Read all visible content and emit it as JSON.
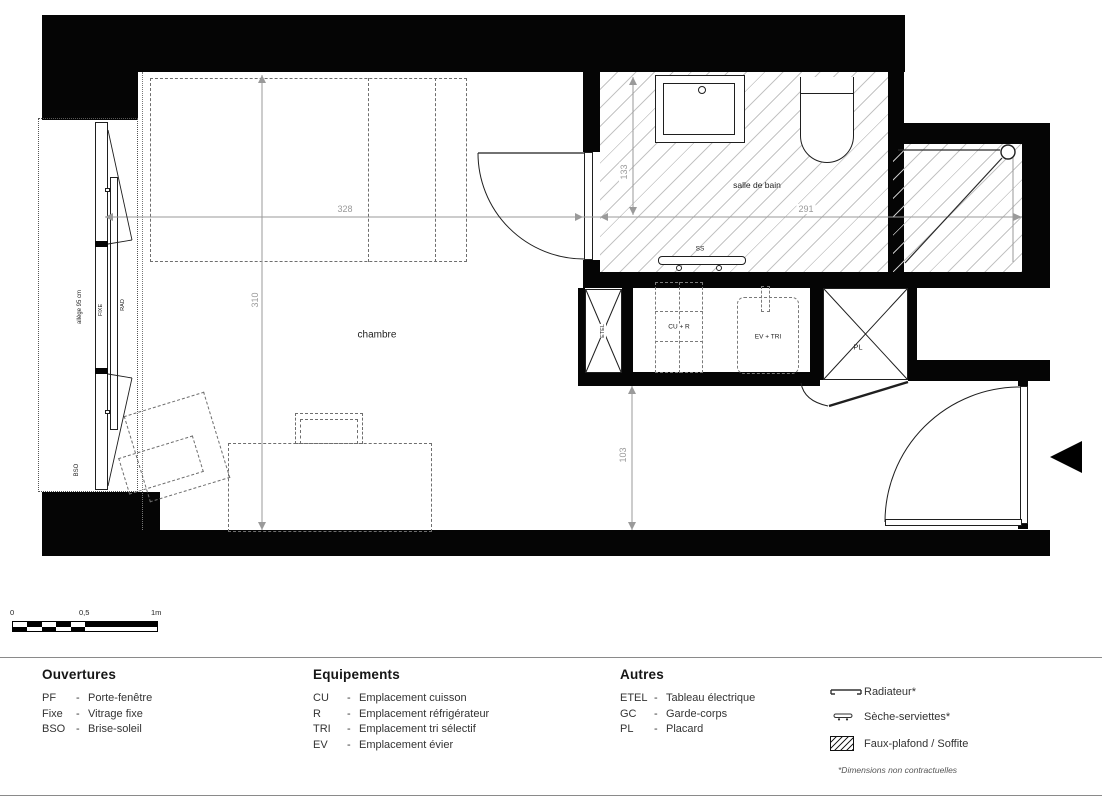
{
  "plan": {
    "room_labels": {
      "chambre": "chambre",
      "salle_de_bain": "salle de bain"
    },
    "equipment_labels": {
      "etel": "ETEL",
      "pl": "PL",
      "cu_r": "CU + R",
      "ev_tri": "EV + TRI",
      "ss": "SS"
    },
    "window_labels": {
      "allege": "allège 95 cm",
      "fixe": "FIXE",
      "rad": "RAD",
      "bso": "BSO"
    },
    "dimensions": {
      "chambre_width": "328",
      "chambre_height": "310",
      "sdb_width": "291",
      "sdb_height": "133",
      "entree_height": "103"
    }
  },
  "scale_bar": {
    "tick_0": "0",
    "tick_half": "0,5",
    "tick_1": "1m"
  },
  "legend": {
    "dash": "-",
    "ouvertures": {
      "title": "Ouvertures",
      "items": [
        {
          "abbr": "PF",
          "label": "Porte-fenêtre"
        },
        {
          "abbr": "Fixe",
          "label": "Vitrage fixe"
        },
        {
          "abbr": "BSO",
          "label": "Brise-soleil"
        }
      ]
    },
    "equipements": {
      "title": "Equipements",
      "items": [
        {
          "abbr": "CU",
          "label": "Emplacement cuisson"
        },
        {
          "abbr": "R",
          "label": "Emplacement réfrigérateur"
        },
        {
          "abbr": "TRI",
          "label": "Emplacement tri sélectif"
        },
        {
          "abbr": "EV",
          "label": "Emplacement évier"
        }
      ]
    },
    "autres": {
      "title": "Autres",
      "items": [
        {
          "abbr": "ETEL",
          "label": "Tableau électrique"
        },
        {
          "abbr": "GC",
          "label": "Garde-corps"
        },
        {
          "abbr": "PL",
          "label": "Placard"
        }
      ]
    },
    "symbols": [
      {
        "label": "Radiateur*"
      },
      {
        "label": "Sèche-serviettes*"
      },
      {
        "label": "Faux-plafond / Soffite"
      }
    ],
    "footnote": "*Dimensions non contractuelles"
  },
  "colors": {
    "wall": "#050505",
    "hatch_line": "#c4c4c4",
    "dim_line": "#9a9a9a",
    "draw_line": "#1f1f1f"
  }
}
